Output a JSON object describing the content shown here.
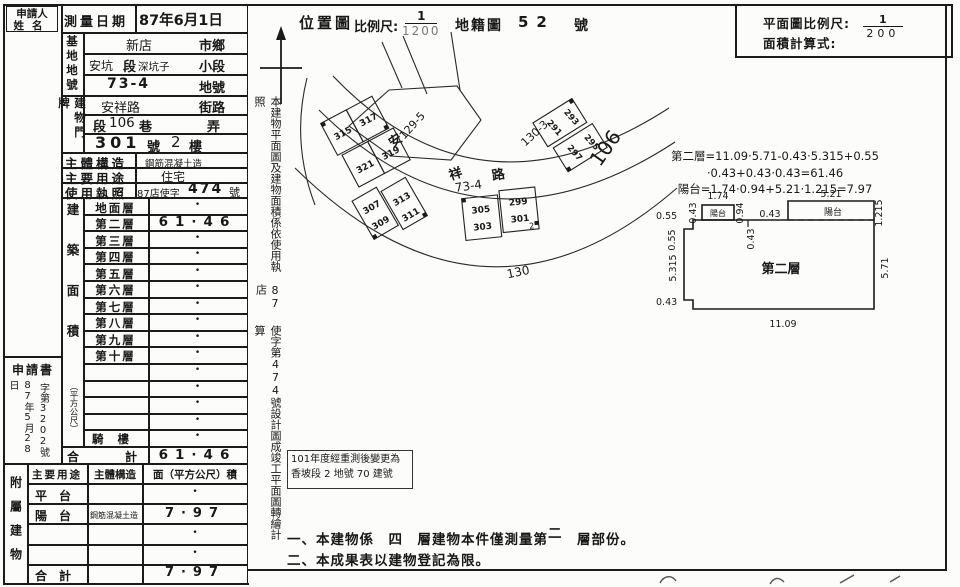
{
  "applicant": {
    "line1": "申請人",
    "line2": "姓名"
  },
  "survey": {
    "label": "測量日期",
    "value": "87年6月1日"
  },
  "site": {
    "group_label": "基地地號",
    "r1": {
      "name": "新店",
      "suffix": "市鄉"
    },
    "r2": {
      "name": "安坑",
      "mid": "段",
      "name2": "深坑子",
      "suffix": "小段"
    },
    "r3": {
      "name": "73-4",
      "suffix": "地號"
    }
  },
  "address": {
    "group_label": "建物門牌",
    "r1": {
      "name": "安祥路",
      "suffix": "街路"
    },
    "r2": {
      "pre": "段",
      "num": "106",
      "post": "巷",
      "suffix": "弄"
    },
    "r3": {
      "num": "301",
      "unit": "號",
      "floor": "2",
      "floor_unit": "樓"
    }
  },
  "info": {
    "structure_label": "主體構造",
    "structure_value": "鋼筋混凝土造",
    "use_label": "主要用途",
    "use_value": "住宅",
    "license_label": "使用執照",
    "license_pre": "87店使字",
    "license_num": "474",
    "license_suffix": "號"
  },
  "floor_area": {
    "side_label": "建築面積",
    "side_label_unit": "（平方公尺）",
    "rows": [
      {
        "label": "地面層",
        "value": "•"
      },
      {
        "label": "第二層",
        "value": "61·46"
      },
      {
        "label": "第三層",
        "value": "•"
      },
      {
        "label": "第四層",
        "value": "•"
      },
      {
        "label": "第五層",
        "value": "•"
      },
      {
        "label": "第六層",
        "value": "•"
      },
      {
        "label": "第七層",
        "value": "•"
      },
      {
        "label": "第八層",
        "value": "•"
      },
      {
        "label": "第九層",
        "value": "•"
      },
      {
        "label": "第十層",
        "value": "•"
      },
      {
        "label": "",
        "value": "•"
      },
      {
        "label": "",
        "value": "•"
      },
      {
        "label": "",
        "value": "•"
      },
      {
        "label": "",
        "value": "•"
      },
      {
        "label": "騎樓",
        "value": "•"
      }
    ],
    "total_label": "合計",
    "total_value": "61·46"
  },
  "application": {
    "title": "申請書",
    "date": "87年5月28日",
    "number": "字第3202號"
  },
  "annex": {
    "side_label": "附屬建物",
    "headers": [
      "主要用途",
      "主體構造",
      "面（平方公尺）積"
    ],
    "rows": [
      {
        "use": "平台",
        "structure": "",
        "area": "•"
      },
      {
        "use": "陽台",
        "structure": "鋼筋混凝土造",
        "area": "7·97"
      },
      {
        "use": "",
        "structure": "",
        "area": "•"
      },
      {
        "use": "",
        "structure": "",
        "area": "•"
      },
      {
        "use": "合計",
        "structure": "",
        "area": "7·97"
      }
    ]
  },
  "map_header": {
    "title": "位置圖",
    "scale_label": "比例尺:",
    "scale_num": "1",
    "scale_den": "1200",
    "cadastral_label": "地籍圖",
    "sheet_no": "52",
    "sheet_suffix": "號"
  },
  "plan_box": {
    "scale_label": "平面圖比例尺:",
    "scale_num": "1",
    "scale_den": "200",
    "formula_label": "面積計算式:"
  },
  "side_note": {
    "part1": "本建物平面圖及建物面積係依使用執照",
    "part2": "87店",
    "part3": "使字第474號設計圖成竣工平面圖轉繪計算"
  },
  "formulas": {
    "line1": "第二層=11.09·5.71-0.43·5.315+0.55",
    "line2": "·0.43+0.43·0.43=61.46",
    "line3": "陽台=1.74·0.94+5.21·1.215=7.97"
  },
  "floor_plan": {
    "room": "第二層",
    "balcony_small": "陽台",
    "balcony_large": "陽台",
    "dims": {
      "left_top": "0.55",
      "left_top_v": "0.43",
      "small_w": "1.74",
      "small_h": "0.94",
      "gap": "0.43",
      "mid_v": "0.43",
      "large_w": "5.21",
      "large_h": "1.215",
      "left_upper": "0.55",
      "left_side": "5.315",
      "bottom_left": "0.43",
      "bottom": "11.09",
      "right_side": "5.71"
    }
  },
  "map": {
    "road_char1": "安",
    "road_char2": "祥",
    "road_char3": "路",
    "lane": "106",
    "lot_a": "129-5",
    "lot_b": "130-3",
    "lot_c": "73-4",
    "lot_d": "130",
    "c1": [
      "315",
      "317",
      "321",
      "319"
    ],
    "c2": [
      "307",
      "309",
      "313",
      "311"
    ],
    "c3": [
      "305",
      "303",
      "299",
      "301"
    ],
    "c3_floor": "2",
    "c4": [
      "291",
      "293",
      "297",
      "295"
    ]
  },
  "remeasure": {
    "line1": "101年度經重測後變更為",
    "line2": "香坡段 2 地號 70 建號"
  },
  "notes": {
    "n1_pre": "一、本建物係　四　層建物本件僅測量第",
    "n1_hand": "二",
    "n1_post": "　層部份。",
    "n2": "二、本成果表以建物登記為限。"
  }
}
